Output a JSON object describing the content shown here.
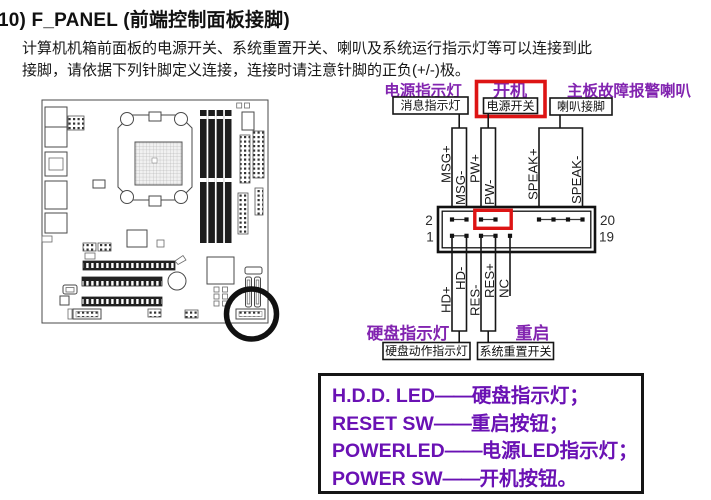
{
  "colors": {
    "purple": "#8224b0",
    "legendPurple": "#6a11b4",
    "red": "#dd1414",
    "line": "#161616"
  },
  "page": {
    "title": "10) F_PANEL (前端控制面板接脚)",
    "body_line1": "计算机机箱前面板的电源开关、系统重置开关、喇叭及系统运行指示灯等可以连接到此",
    "body_line2": "接脚，请依据下列针脚定义连接，连接时请注意针脚的正负(+/-)极。"
  },
  "diagram": {
    "top_labels": {
      "power_led": "电源指示灯",
      "power_on": "开机",
      "speaker_alarm": "主板故障报警喇叭"
    },
    "top_boxes": {
      "message_led": "消息指示灯",
      "power_switch": "电源开关",
      "speaker_pins": "喇叭接脚"
    },
    "pin_labels_top": [
      "MSG+",
      "MSG-",
      "PW+",
      "PW-",
      "SPEAK+",
      "SPEAK-"
    ],
    "pin_labels_bottom": [
      "HD+",
      "HD-",
      "RES-",
      "RES+",
      "NC"
    ],
    "pin_numbers": {
      "top_left": "2",
      "bottom_left": "1",
      "top_right": "20",
      "bottom_right": "19"
    },
    "bottom_labels": {
      "hdd_led": "硬盘指示灯",
      "reset": "重启"
    },
    "bottom_boxes": {
      "hdd_activity": "硬盘动作指示灯",
      "reset_switch": "系统重置开关"
    }
  },
  "legend": {
    "dash": "——",
    "lines": [
      {
        "en": "H.D.D. LED",
        "zh": "硬盘指示灯；"
      },
      {
        "en": "RESET SW",
        "zh": "重启按钮；"
      },
      {
        "en": "POWERLED",
        "zh": "电源LED指示灯；"
      },
      {
        "en": "POWER SW",
        "zh": "开机按钮。"
      }
    ]
  }
}
